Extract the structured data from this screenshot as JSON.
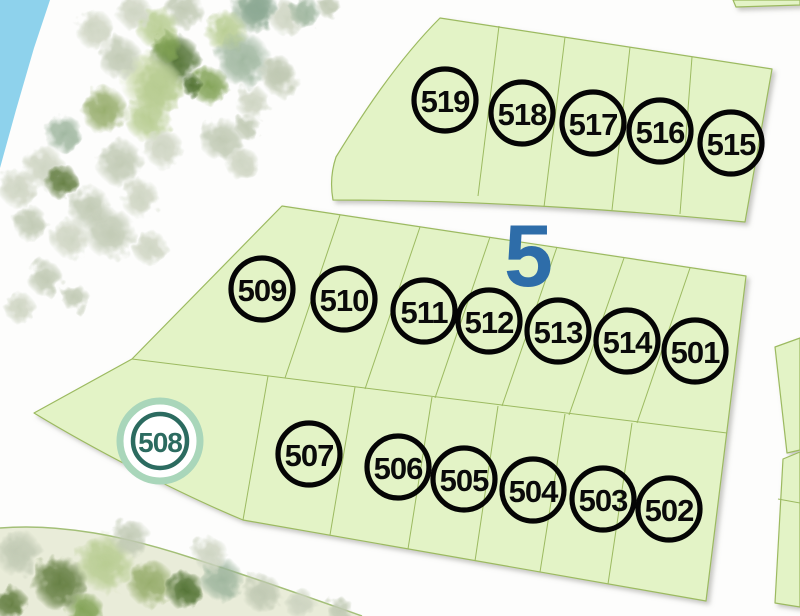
{
  "map": {
    "block_label": "5",
    "highlighted_lot": "508",
    "lot_markers": [
      {
        "id": "519",
        "x": 445,
        "y": 100
      },
      {
        "id": "518",
        "x": 522,
        "y": 113
      },
      {
        "id": "517",
        "x": 593,
        "y": 123
      },
      {
        "id": "516",
        "x": 660,
        "y": 131
      },
      {
        "id": "515",
        "x": 731,
        "y": 143
      },
      {
        "id": "509",
        "x": 262,
        "y": 289
      },
      {
        "id": "510",
        "x": 344,
        "y": 299
      },
      {
        "id": "511",
        "x": 424,
        "y": 311
      },
      {
        "id": "512",
        "x": 489,
        "y": 321
      },
      {
        "id": "513",
        "x": 558,
        "y": 331
      },
      {
        "id": "514",
        "x": 627,
        "y": 341
      },
      {
        "id": "501",
        "x": 695,
        "y": 351
      },
      {
        "id": "508",
        "x": 160,
        "y": 441,
        "highlighted": true
      },
      {
        "id": "507",
        "x": 309,
        "y": 454
      },
      {
        "id": "506",
        "x": 398,
        "y": 467
      },
      {
        "id": "505",
        "x": 464,
        "y": 479
      },
      {
        "id": "504",
        "x": 533,
        "y": 490
      },
      {
        "id": "503",
        "x": 603,
        "y": 499
      },
      {
        "id": "502",
        "x": 669,
        "y": 509
      }
    ],
    "colors": {
      "water": "#8ed2ec",
      "parcel_fill": "#e3f3c6",
      "parcel_stroke": "#9cba60",
      "path_fill": "#e9ecd9",
      "path_stroke": "#a3bf77",
      "marker_stroke": "#050505",
      "marker_text": "#0a0a0a",
      "highlight_ring": "#a9d6ba",
      "highlight_accent": "#2c6b60",
      "block_label": "#2e6da9"
    },
    "tree_colors": {
      "dark": "#4e6f2f",
      "darkOlive": "#5f7a3c",
      "mid": "#7fa052",
      "olive": "#93aa67",
      "lightOlive": "#b6cb8f",
      "paleGreen": "#c9d8a8",
      "sage": "#9cb49c",
      "sage2": "#8ba893",
      "gray1": "#ccd3c0",
      "gray2": "#bfc8b2",
      "grayPale": "#d8dccc"
    },
    "shapes": {
      "water": "M0,0 L50,0 L34,48 L16,110 L0,168 Z",
      "strip_fill": "M0,528 C60,523 125,536 192,558 C255,578 305,596 362,616 L0,616 Z",
      "strip_stroke": "M0,528 C60,523 125,536 192,558 C255,578 305,596 362,616",
      "parcels": [
        {
          "name": "parcel-block-top",
          "d": "M440,18 L772,69 L745,222 Q520,200 333,200 Q329,178 336,157 C360,118 396,62 440,18 Z"
        },
        {
          "name": "parcel-block-main",
          "d": "M282,206 L746,276 L706,601 L243,520 C190,498 105,456 34,413 L132,359 Z"
        },
        {
          "name": "parcel-neighbor-upper",
          "d": "M775,347 L800,338 L800,450 L787,453 Z"
        },
        {
          "name": "parcel-neighbor-lower",
          "d": "M783,459 L800,452 L800,607 L775,603 Z"
        },
        {
          "name": "parcel-edge-top",
          "d": "M733,0 L800,0 L800,5 L736,7 Z"
        }
      ]
    },
    "dividers": [
      [
        499,
        26,
        478,
        196
      ],
      [
        565,
        37,
        544,
        207
      ],
      [
        630,
        47,
        612,
        210
      ],
      [
        692,
        57,
        680,
        214
      ],
      [
        132,
        359,
        727,
        433
      ],
      [
        340,
        215,
        285,
        378
      ],
      [
        420,
        227,
        365,
        389
      ],
      [
        490,
        237,
        435,
        398
      ],
      [
        557,
        247,
        502,
        406
      ],
      [
        624,
        258,
        569,
        415
      ],
      [
        690,
        268,
        637,
        423
      ],
      [
        268,
        376,
        243,
        520
      ],
      [
        355,
        387,
        330,
        535
      ],
      [
        432,
        397,
        408,
        549
      ],
      [
        498,
        406,
        475,
        561
      ],
      [
        565,
        414,
        540,
        572
      ],
      [
        632,
        423,
        608,
        584
      ],
      [
        778,
        499,
        800,
        503
      ]
    ],
    "trees": [
      [
        253,
        10,
        24,
        "sage"
      ],
      [
        226,
        32,
        22,
        "lightOlive"
      ],
      [
        287,
        18,
        18,
        "gray1"
      ],
      [
        184,
        10,
        20,
        "gray2"
      ],
      [
        158,
        28,
        22,
        "lightOlive"
      ],
      [
        134,
        12,
        18,
        "gray1"
      ],
      [
        176,
        60,
        26,
        "dark"
      ],
      [
        243,
        60,
        28,
        "sage"
      ],
      [
        281,
        80,
        18,
        "gray1"
      ],
      [
        210,
        86,
        20,
        "mid"
      ],
      [
        150,
        80,
        30,
        "paleGreen"
      ],
      [
        167,
        46,
        16,
        "mid"
      ],
      [
        160,
        88,
        26,
        "lightOlive"
      ],
      [
        120,
        58,
        22,
        "gray2"
      ],
      [
        95,
        30,
        20,
        "gray1"
      ],
      [
        148,
        118,
        24,
        "lightOlive"
      ],
      [
        192,
        86,
        11,
        "dark"
      ],
      [
        104,
        110,
        24,
        "olive"
      ],
      [
        64,
        134,
        20,
        "sage"
      ],
      [
        44,
        168,
        22,
        "gray1"
      ],
      [
        120,
        163,
        24,
        "gray2"
      ],
      [
        163,
        148,
        20,
        "gray1"
      ],
      [
        222,
        140,
        22,
        "gray2"
      ],
      [
        242,
        163,
        17,
        "gray1"
      ],
      [
        90,
        208,
        22,
        "gray2"
      ],
      [
        62,
        182,
        18,
        "darkOlive"
      ],
      [
        140,
        198,
        20,
        "gray1"
      ],
      [
        110,
        233,
        26,
        "gray2"
      ],
      [
        70,
        238,
        20,
        "gray1"
      ],
      [
        30,
        223,
        18,
        "gray2"
      ],
      [
        150,
        248,
        18,
        "gray1"
      ],
      [
        18,
        188,
        20,
        "gray1"
      ],
      [
        45,
        278,
        18,
        "gray2"
      ],
      [
        20,
        308,
        16,
        "gray1"
      ],
      [
        75,
        298,
        14,
        "gray2"
      ],
      [
        258,
        8,
        20,
        "sage2"
      ],
      [
        277,
        73,
        18,
        "gray2"
      ],
      [
        252,
        102,
        17,
        "gray1"
      ],
      [
        248,
        128,
        13,
        "gray2"
      ],
      [
        305,
        12,
        16,
        "sage"
      ],
      [
        330,
        8,
        12,
        "gray2"
      ],
      [
        18,
        553,
        24,
        "gray2"
      ],
      [
        60,
        583,
        28,
        "darkOlive"
      ],
      [
        105,
        563,
        30,
        "lightOlive"
      ],
      [
        150,
        583,
        24,
        "olive"
      ],
      [
        185,
        590,
        20,
        "dark"
      ],
      [
        222,
        580,
        22,
        "sage"
      ],
      [
        262,
        593,
        20,
        "gray2"
      ],
      [
        300,
        604,
        16,
        "gray1"
      ],
      [
        130,
        538,
        20,
        "gray2"
      ],
      [
        210,
        554,
        18,
        "gray1"
      ],
      [
        10,
        603,
        18,
        "darkOlive"
      ],
      [
        340,
        610,
        14,
        "gray2"
      ],
      [
        85,
        612,
        20,
        "mid"
      ]
    ]
  }
}
